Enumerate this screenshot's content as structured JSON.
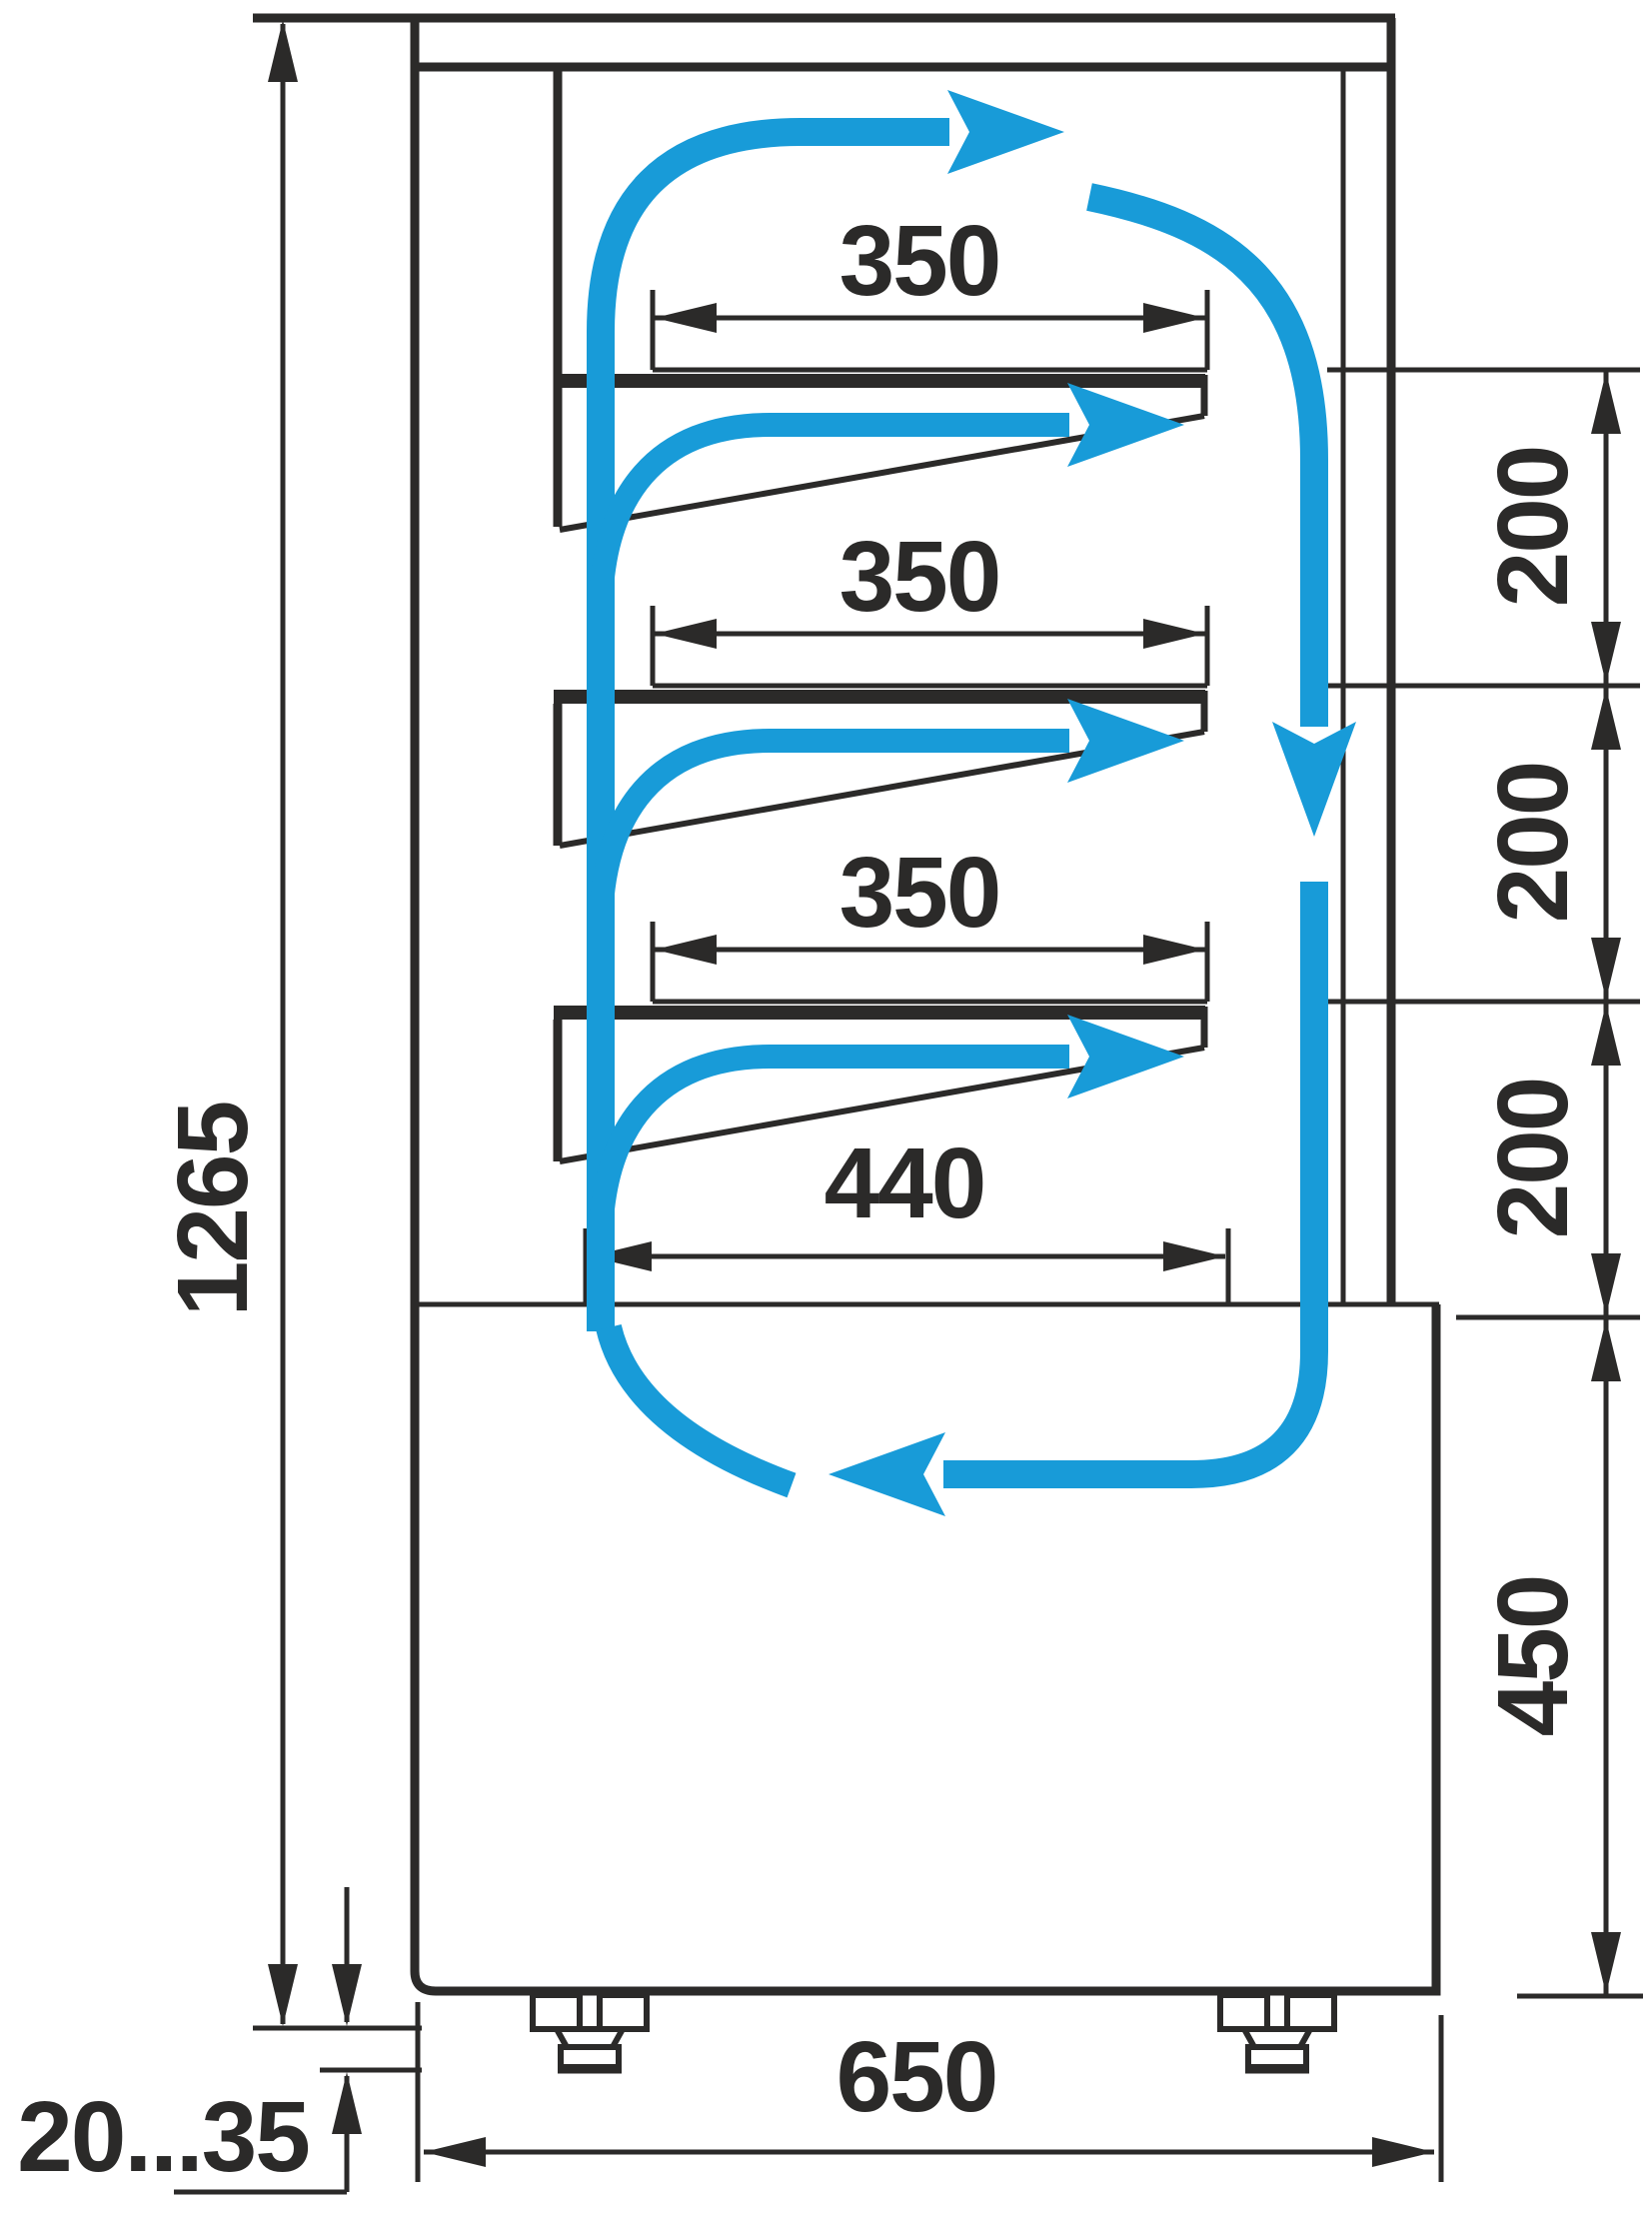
{
  "drawing": {
    "title": "refrigerated-display-case-side-section-airflow-diagram",
    "palette": {
      "ink": "#2B2A29",
      "airflow": "#189BD8",
      "background": "#FFFFFF"
    },
    "labels": {
      "overall_height": "1265",
      "shelf_depth_1": "350",
      "shelf_depth_2": "350",
      "shelf_depth_3": "350",
      "bottom_shelf_depth": "440",
      "shelf_gap_1": "200",
      "shelf_gap_2": "200",
      "shelf_gap_3": "200",
      "base_height": "450",
      "overall_depth": "650",
      "foot_adjust_range": "20...35"
    },
    "units": "mm"
  }
}
